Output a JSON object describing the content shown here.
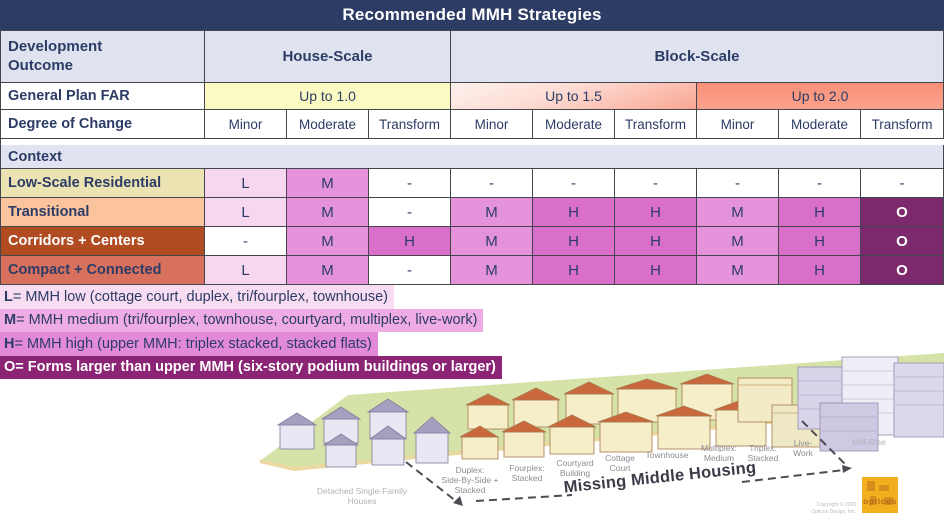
{
  "title": "Recommended MMH Strategies",
  "table": {
    "corner_label": "Development\nOutcome",
    "scale_headers": [
      {
        "label": "House-Scale"
      },
      {
        "label": "Block-Scale"
      }
    ],
    "far_row": {
      "label": "General Plan FAR",
      "cells": [
        {
          "label": "Up to 1.0"
        },
        {
          "label": "Up to 1.5"
        },
        {
          "label": "Up to 2.0"
        }
      ]
    },
    "degree_row": {
      "label": "Degree of Change",
      "cells": [
        "Minor",
        "Moderate",
        "Transform",
        "Minor",
        "Moderate",
        "Transform",
        "Minor",
        "Moderate",
        "Transform"
      ]
    },
    "context_header": "Context",
    "context_rows": [
      {
        "label": "Low-Scale Residential",
        "cells": [
          "L",
          "M",
          "-",
          "-",
          "-",
          "-",
          "-",
          "-",
          "-"
        ]
      },
      {
        "label": "Transitional",
        "cells": [
          "L",
          "M",
          "-",
          "M",
          "H",
          "H",
          "M",
          "H",
          "O"
        ]
      },
      {
        "label": "Corridors + Centers",
        "cells": [
          "-",
          "M",
          "H",
          "M",
          "H",
          "H",
          "M",
          "H",
          "O"
        ]
      },
      {
        "label": "Compact + Connected",
        "cells": [
          "L",
          "M",
          "-",
          "M",
          "H",
          "H",
          "M",
          "H",
          "O"
        ]
      }
    ]
  },
  "legend": [
    {
      "key": "L",
      "rest": " = MMH low (cottage court, duplex, tri/fourplex, townhouse)"
    },
    {
      "key": "M",
      "rest": " = MMH medium (tri/fourplex, townhouse, courtyard, multiplex, live-work)"
    },
    {
      "key": "H",
      "rest": " = MMH high (upper MMH: triplex stacked, stacked flats)"
    },
    {
      "key": "O",
      "rest": " = Forms larger than upper MMH (six-story podium buildings or larger)"
    }
  ],
  "illustration": {
    "building_labels": [
      "Detached Single-Family\nHouses",
      "Duplex:\nSide-By-Side +\nStacked",
      "Fourplex:\nStacked",
      "Courtyard\nBuilding",
      "Cottage\nCourt",
      "Townhouse",
      "Multiplex:\nMedium",
      "Triplex:\nStacked",
      "Live-\nWork",
      "Mid-Rise"
    ],
    "arrow_label": "Missing Middle Housing",
    "logo_text": "opticos",
    "copyright_line1": "Copyright © 2020",
    "copyright_line2": "Opticos Design, Inc."
  },
  "colors": {
    "header_navy": "#2d3c64",
    "lavender_header": "#dfe3ef",
    "far_yellow": "#fafac2",
    "far_salmon": "#f89480",
    "mmh_low": "#f6d7ef",
    "mmh_medium": "#e493da",
    "mmh_high": "#d96fc9",
    "mmh_larger": "#7c2a6d",
    "ctx_low_scale": "#ebe4b2",
    "ctx_transitional": "#fbc49d",
    "ctx_corridors": "#b14b21",
    "ctx_compact": "#d7705c"
  }
}
